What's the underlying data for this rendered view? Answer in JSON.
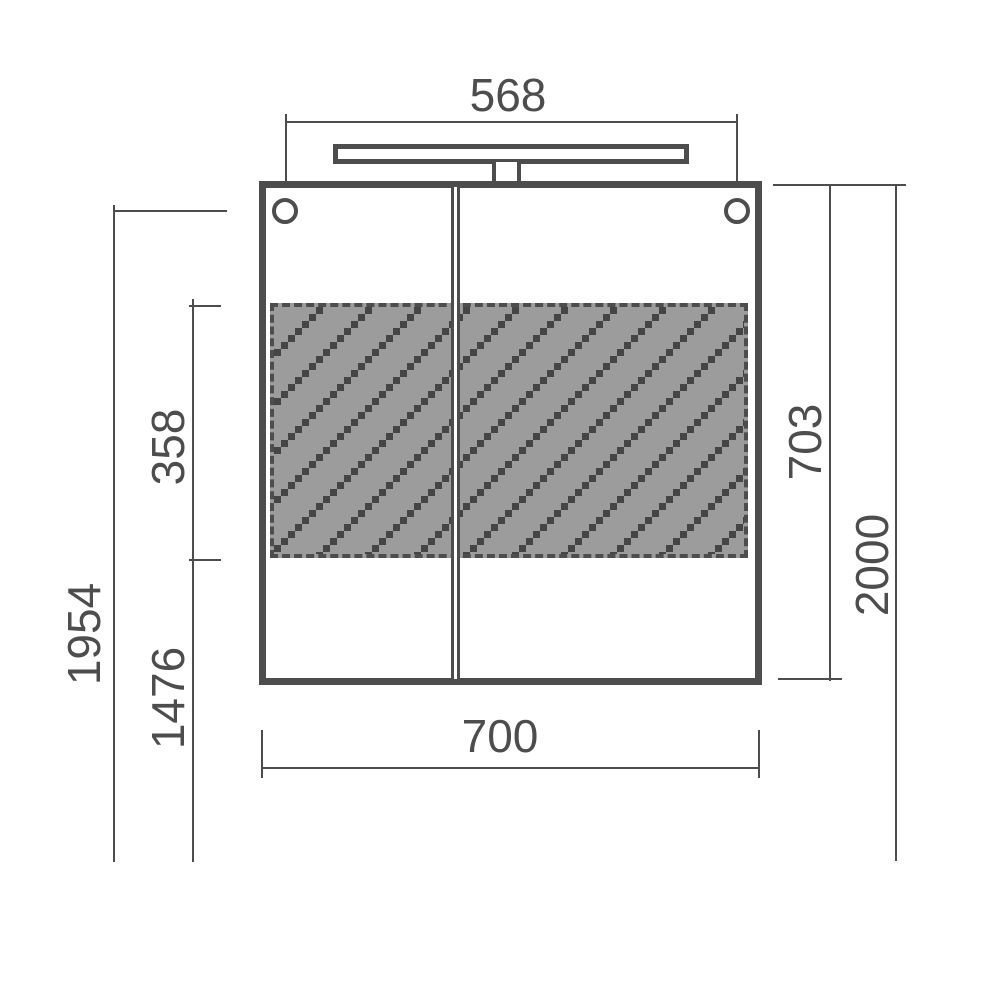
{
  "drawing": {
    "type": "technical dimension drawing",
    "subject": "mirror cabinet with top light, front view",
    "units": "mm"
  },
  "dims": {
    "hole_spacing": "568",
    "cabinet_width": "700",
    "cabinet_height": "703",
    "hatch_height": "358",
    "hatch_bottom_height": "1476",
    "hole_height": "1954",
    "total_height": "2000"
  },
  "colors": {
    "line": "#4d4d4d",
    "hatch_fill": "#9c9c9c",
    "hatch_square": "#454545",
    "background": "#ffffff"
  }
}
